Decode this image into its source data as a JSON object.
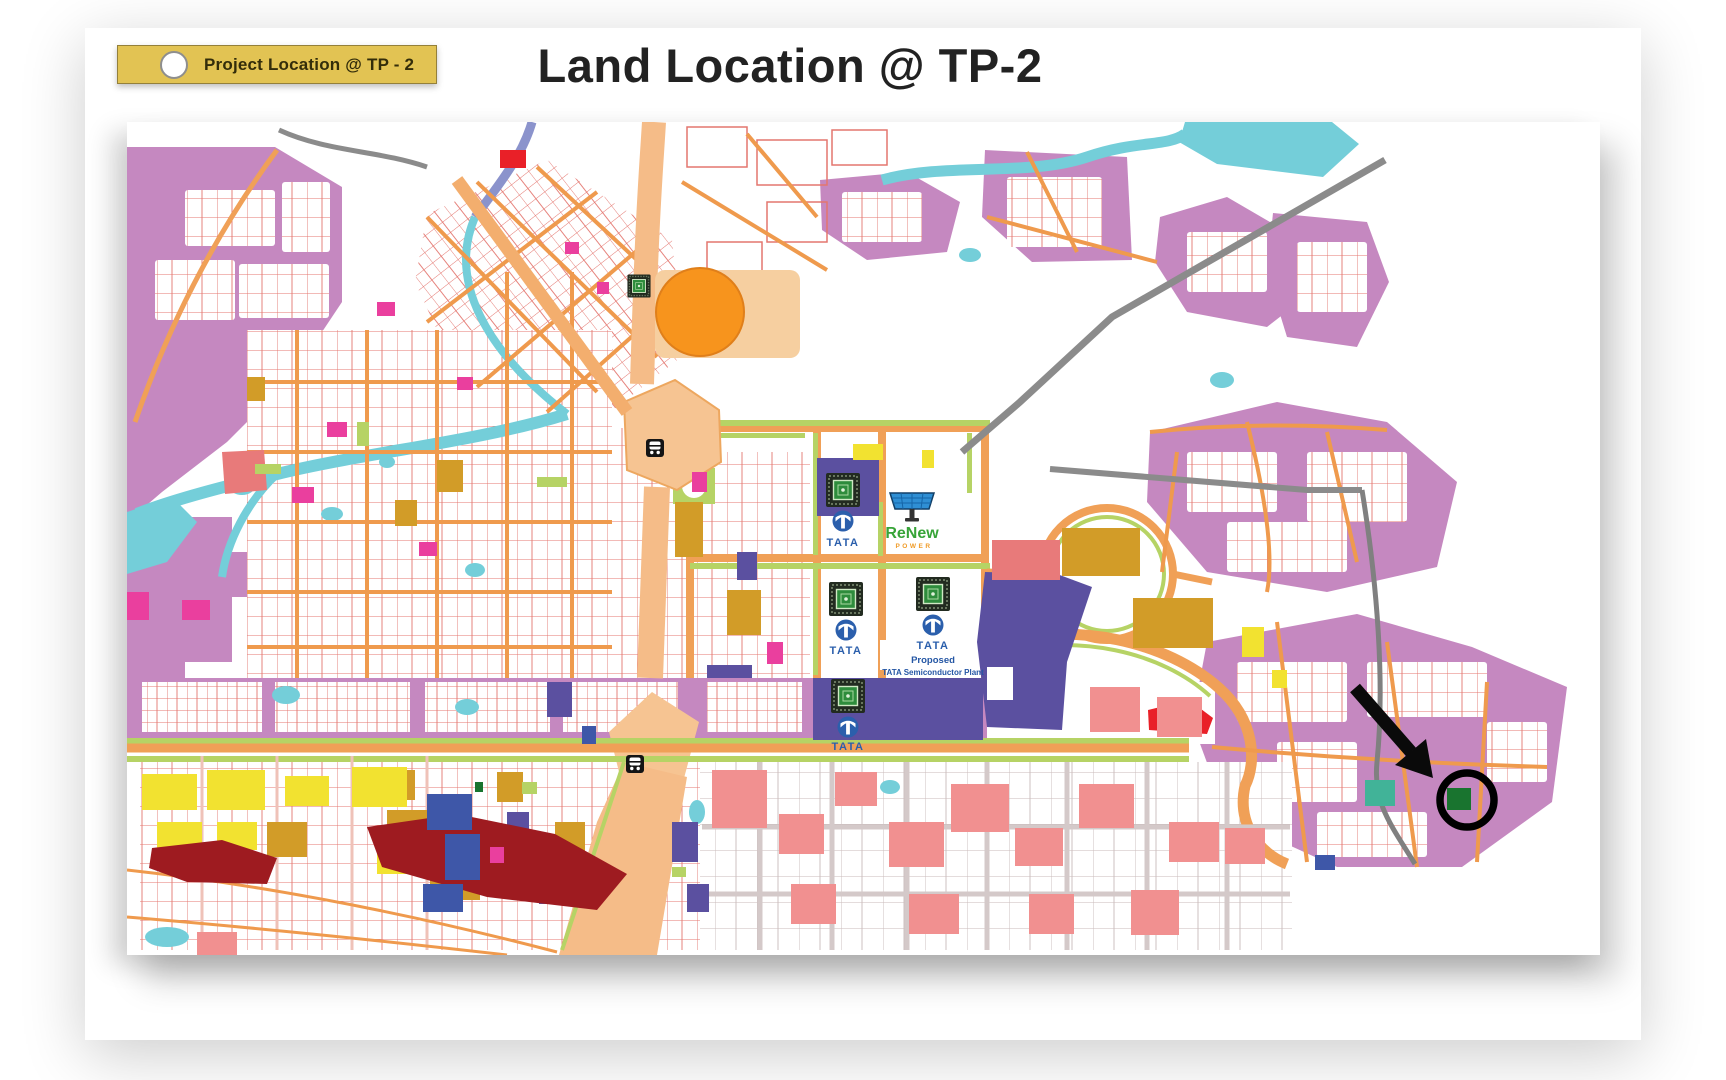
{
  "title": "Land Location @ TP-2",
  "legend": {
    "label": "Project Location @ TP - 2",
    "badge_color": "#e2c353",
    "marker_fill": "#ffffff"
  },
  "map": {
    "tata_label": "TATA",
    "renew_label": "ReNew",
    "renew_sub_label": "POWER",
    "proposed_label_line1": "Proposed",
    "proposed_label_line2": "TATA Semiconductor Plant",
    "colors": {
      "residential_plum": "#c588c0",
      "road_orange": "#f0a057",
      "wide_road_peach": "#f5bc88",
      "green_belt": "#b6d365",
      "water_cyan": "#74ced9",
      "industrial_purple": "#5b50a0",
      "goldenrod_zone": "#d29c28",
      "yellow_zone": "#f2e230",
      "red_zone": "#e92028",
      "maroon_zone": "#9e1b20",
      "salmon_zone": "#f19090",
      "blue_zone": "#3e57a8",
      "magenta_zone": "#ea3f9e",
      "teal_parcel": "#41b398",
      "project_parcel_green": "#19742f",
      "highway_gray": "#8b8b8b",
      "tata_blue": "#2b5fac",
      "renew_green": "#37a438",
      "renew_power_orange": "#f09b27"
    }
  }
}
